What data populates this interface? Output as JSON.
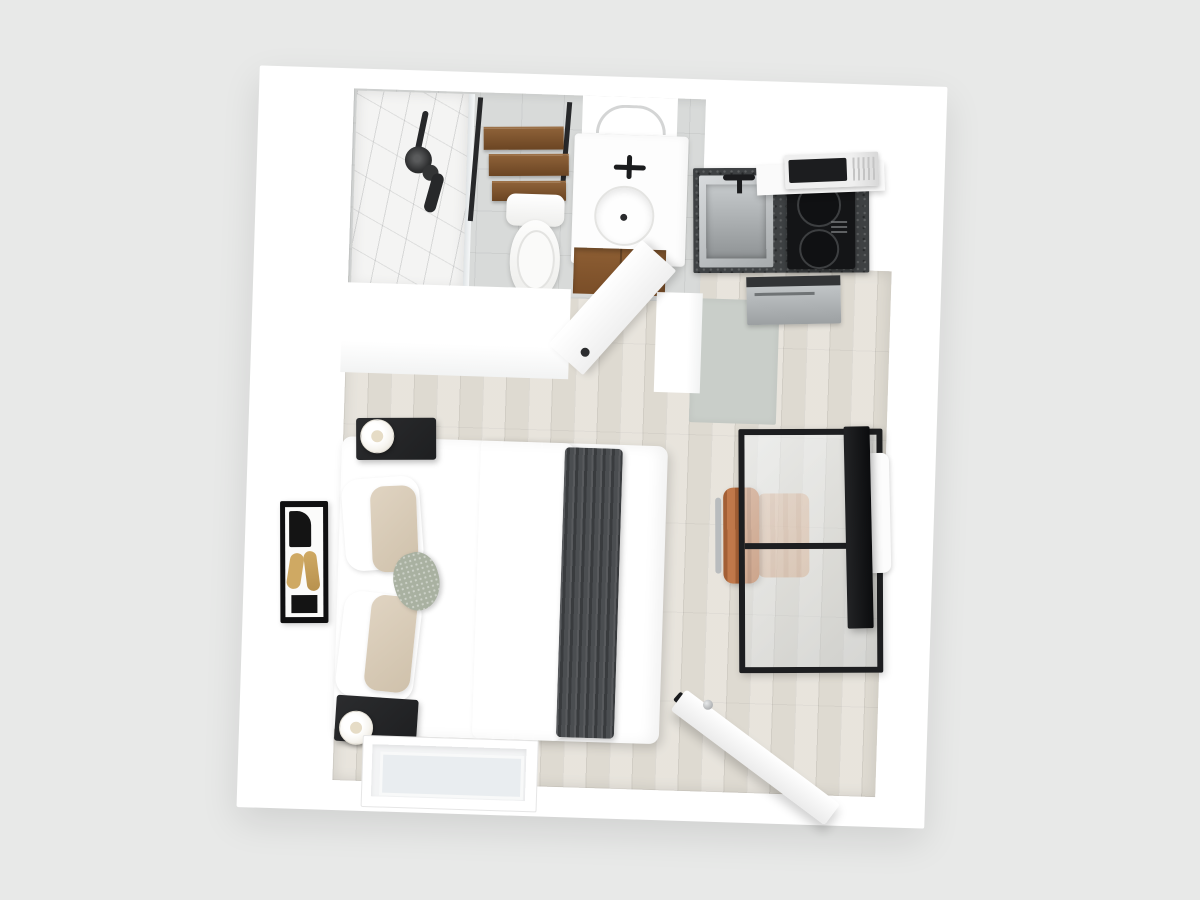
{
  "meta": {
    "type": "3d-floor-plan-render",
    "view": "top-down",
    "description": "Top-down 3D rendering of a studio apartment floor plan"
  },
  "palette": {
    "bg": "#e8e9e8",
    "wall": "#ffffff",
    "wall-shade": "#f2f3f3",
    "wood": "#e3dfd6",
    "wood-seam": "#d6d1c6",
    "tile": "#d8dad9",
    "marble": "#f4f4f3",
    "glass": "#e9edf0",
    "granite": "#3e4143",
    "steel-light": "#d8dbdd",
    "steel-dark": "#8f9395",
    "ink": "#1b1c1e",
    "charcoal": "#27282a",
    "throw": "#4b4e51",
    "beige": "#d8c9b3",
    "beige-2": "#e0d4c2",
    "sage": "#a9b1a1",
    "leather": "#c0784a",
    "leather-2": "#a35f35",
    "shelf-wood": "#815a35",
    "cabinet-wood": "#865a30",
    "gold": "#cfa963",
    "mat": "#c9cec9",
    "lamp": "#f7f5f0"
  },
  "labels": {
    "plan": "Studio apartment 3D floor plan",
    "bathroom": "Bathroom",
    "kitchen": "Kitchenette",
    "bedroom": "Bedroom / living area",
    "shower": "Walk-in marble shower",
    "shower_fixture": "Black shower fixture",
    "shelf": "Over-toilet ladder shelving",
    "toilet": "Toilet",
    "vanity": "Vanity with oval sink",
    "niche": "Vanity niche",
    "cabinet": "Wood vanity cabinet",
    "bathroom_door": "Bathroom door (open)",
    "countertop": "Granite countertop",
    "kitchen_sink": "Stainless kitchen sink",
    "cooktop": "Two-burner cooktop",
    "microwave": "Microwave",
    "appliance": "Under-counter appliance",
    "mat": "Kitchen floor mat",
    "bed": "Queen bed with beige runner and charcoal throw",
    "pillow": "Pillow",
    "nightstand": "Black nightstand",
    "lamp": "Table lamp",
    "art": "Framed wall art",
    "window": "Window",
    "desk": "Black metal glass-top desk",
    "chair": "Tan leather office chair",
    "tv": "Wall-mounted TV",
    "tv_mount": "TV wall mount",
    "entry_door": "Entry door (open)"
  },
  "rooms": {
    "bathroom": {
      "name": "Bathroom",
      "fixtures": [
        "walk-in marble shower",
        "rain shower head",
        "hand shower",
        "glass partition",
        "ladder shelf over toilet",
        "toilet",
        "vanity with oval sink",
        "black faucet",
        "wood cabinet",
        "open door"
      ]
    },
    "kitchen": {
      "name": "Kitchenette",
      "fixtures": [
        "granite countertop",
        "stainless sink",
        "black faucet",
        "two-burner cooktop",
        "microwave on shelf",
        "under-counter stainless appliance",
        "gray floor mat"
      ]
    },
    "bedroom": {
      "name": "Bedroom / living area",
      "furniture": [
        "queen bed",
        "white and beige pillows",
        "sage accent pillow",
        "beige runner blanket",
        "charcoal throw",
        "two black nightstands",
        "two white table lamps",
        "framed wall art",
        "window",
        "glass-top desk",
        "tan leather office chair",
        "wall-mounted TV",
        "open entry door"
      ]
    }
  }
}
